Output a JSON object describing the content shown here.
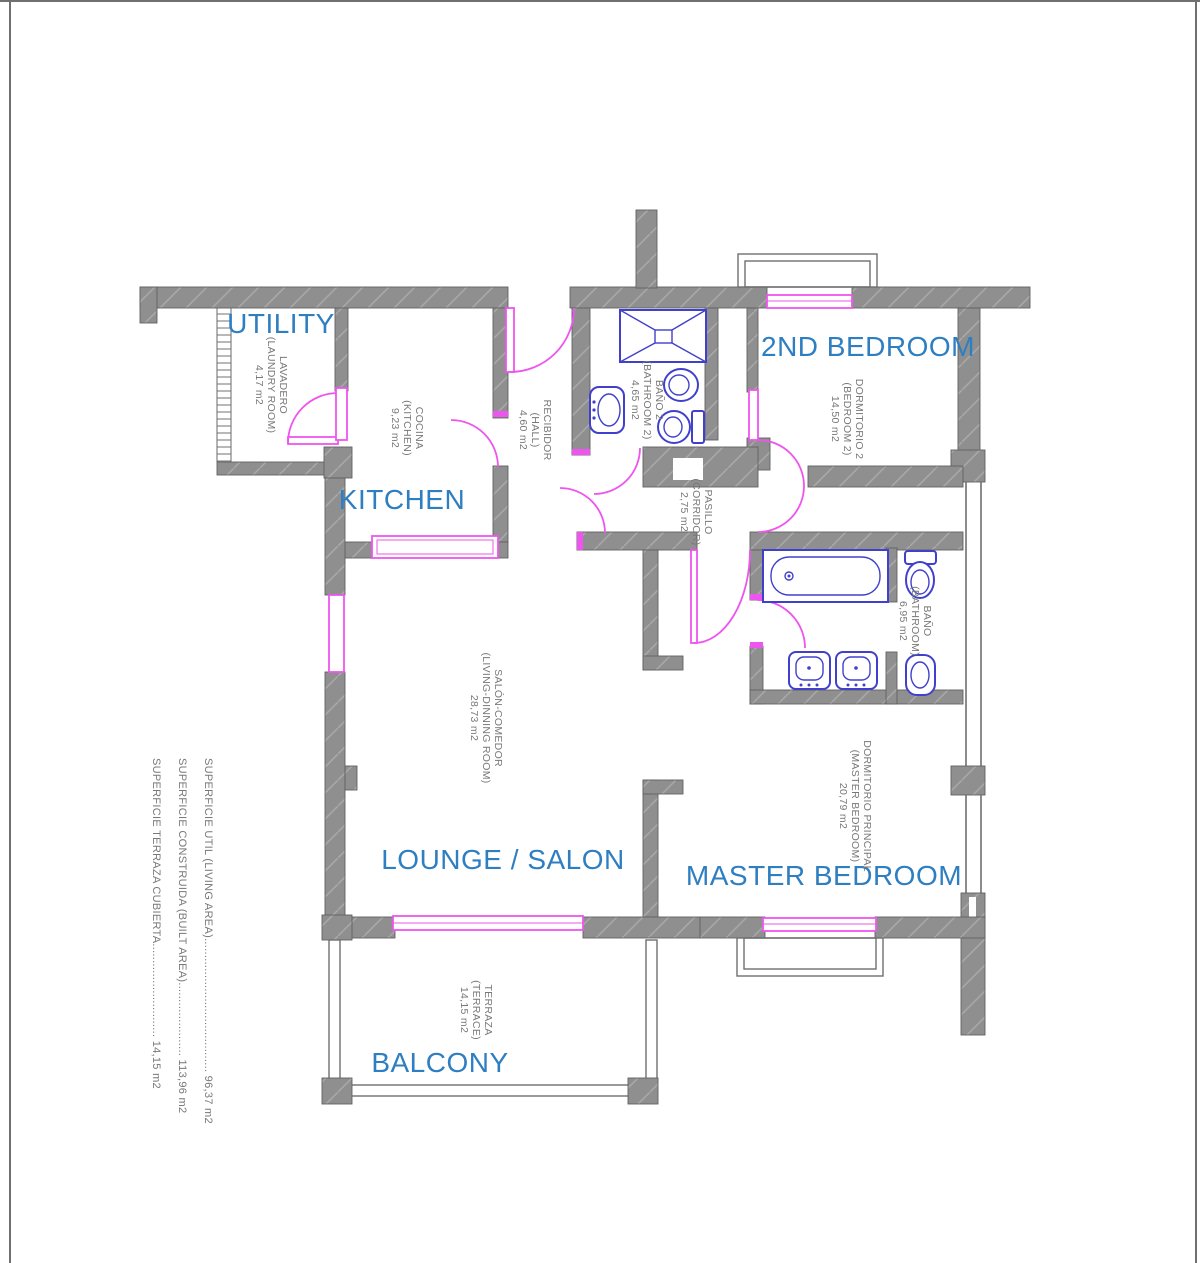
{
  "colors": {
    "room_label_blue": "#2e7ec2",
    "annotation_gray": "#787878",
    "wall_gray": "#8f8f8f",
    "opening_magenta": "#ee55ee",
    "fixture_blue": "#4040cc",
    "background": "#ffffff"
  },
  "rooms": [
    {
      "id": "utility",
      "label": "UTILITY",
      "name_es": "LAVADERO",
      "name_en": "(LAUNDRY ROOM)",
      "area": "4,17 m2"
    },
    {
      "id": "kitchen",
      "label": "KITCHEN",
      "name_es": "COCINA",
      "name_en": "(KITCHEN)",
      "area": "9,23 m2"
    },
    {
      "id": "hall",
      "label": "",
      "name_es": "RECIBIDOR",
      "name_en": "(HALL)",
      "area": "4,60 m2"
    },
    {
      "id": "bathroom-2",
      "label": "",
      "name_es": "BAÑO 2",
      "name_en": "(BATHROOM 2)",
      "area": "4,65 m2"
    },
    {
      "id": "second-bedroom",
      "label": "2ND BEDROOM",
      "name_es": "DORMITORIO 2",
      "name_en": "(BEDROOM 2)",
      "area": "14,50 m2"
    },
    {
      "id": "corridor",
      "label": "",
      "name_es": "PASILLO",
      "name_en": "(CORRIDOR)",
      "area": "2,75 m2"
    },
    {
      "id": "bathroom",
      "label": "",
      "name_es": "BAÑO",
      "name_en": "(BATHROOM)",
      "area": "6,95 m2"
    },
    {
      "id": "lounge",
      "label": "LOUNGE / SALON",
      "name_es": "SALÓN-COMEDOR",
      "name_en": "(LIVING-DINNING ROOM)",
      "area": "28,73 m2"
    },
    {
      "id": "master-bedroom",
      "label": "MASTER BEDROOM",
      "name_es": "DORMITORIO PRINCIPAL",
      "name_en": "(MASTER BEDROOM)",
      "area": "20,79 m2"
    },
    {
      "id": "balcony",
      "label": "BALCONY",
      "name_es": "TERRAZA",
      "name_en": "(TERRACE)",
      "area": "14,15 m2"
    }
  ],
  "summary": {
    "items": [
      {
        "label": "SUPERFICIE UTIL (LIVING AREA)",
        "leader": "........................................",
        "value": "96,37 m2"
      },
      {
        "label": "SUPERFICIE CONSTRUIDA (BUILT AREA)",
        "leader": "......................",
        "value": "113,96 m2"
      },
      {
        "label": "SUPERFICIE TERRAZA CUBIERTA",
        "leader": "............................",
        "value": "14,15 m2"
      }
    ]
  }
}
